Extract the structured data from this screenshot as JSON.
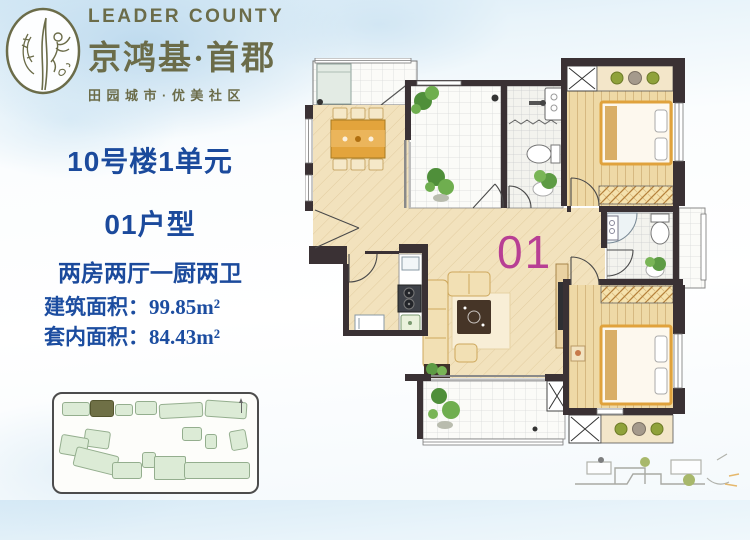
{
  "logo": {
    "name_en": "LEADER COUNTY",
    "name_cn": "京鸿基·首郡",
    "tagline": "田园城市·优美社区",
    "color": "#6b6c49"
  },
  "unit_info": {
    "building": "10号楼1单元",
    "unit_type": "01户型",
    "layout": "两房两厅一厨两卫",
    "built_area_label": "建筑面积：",
    "built_area_value": "99.85m²",
    "inner_area_label": "套内面积：",
    "inner_area_value": "84.43m²",
    "text_color": "#1b4a9c"
  },
  "floorplan": {
    "unit_label": "01",
    "unit_label_color": "#b83f94",
    "wall_color": "#3a3134",
    "wood_floor_color": "#f2e2bd",
    "plank_floor_color": "#eed9a6"
  },
  "siteplan": {
    "building_color": "#dcebd6",
    "highlight_color": "#6f7046"
  }
}
